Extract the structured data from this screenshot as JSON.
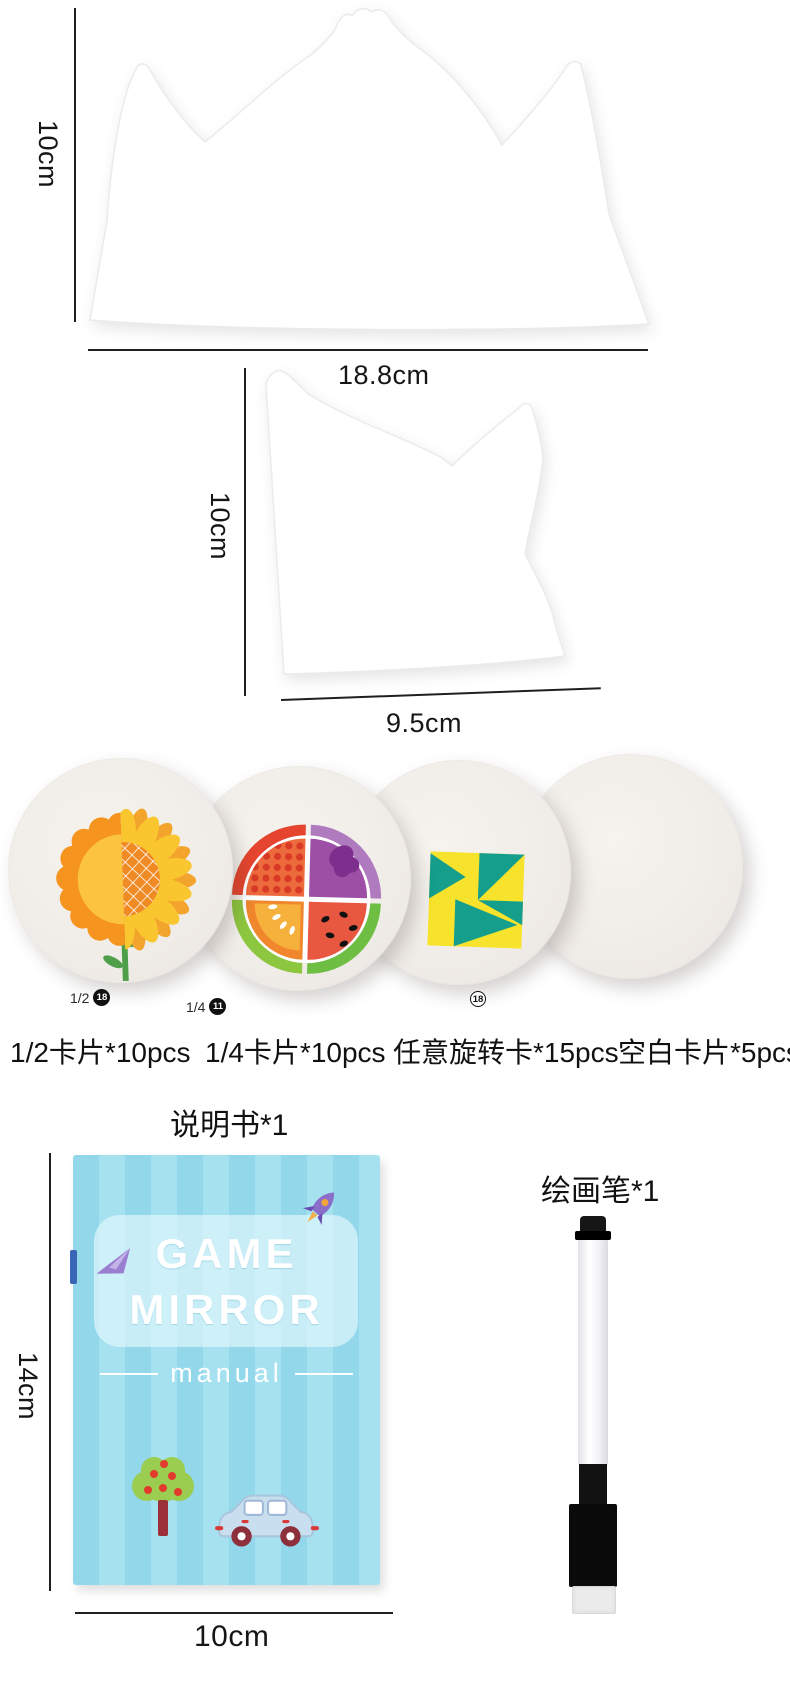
{
  "boards": {
    "large": {
      "height_label": "10cm",
      "width_label": "18.8cm"
    },
    "half": {
      "height_label": "10cm",
      "width_label": "9.5cm"
    }
  },
  "cards": {
    "items": [
      {
        "caption": "1/2卡片*10pcs",
        "badge_prefix": "1/2",
        "badge_number": "18"
      },
      {
        "caption": "1/4卡片*10pcs",
        "badge_prefix": "1/4",
        "badge_number": "11"
      },
      {
        "caption": "任意旋转卡*15pcs",
        "badge_prefix": "",
        "badge_number": "18"
      },
      {
        "caption": "空白卡片*5pcs",
        "badge_prefix": "",
        "badge_number": ""
      }
    ]
  },
  "manual": {
    "label": "说明书*1",
    "cover_title_line1": "GAME",
    "cover_title_line2": "MIRROR",
    "cover_subtitle": "manual",
    "height_label": "14cm",
    "width_label": "10cm"
  },
  "pen": {
    "label": "绘画笔*1"
  },
  "colors": {
    "dimension_line": "#1f1f1f",
    "card_surface": "#f1ede9",
    "sun_orange": "#F5941F",
    "sun_core_yellow": "#FBC340",
    "petal_yellow": "#F9C62F",
    "petal_orange": "#F2A42C",
    "flower_center_orange": "#EF8A24",
    "stem_green": "#4E9E4A",
    "rim_red": "#E5452E",
    "rim_purple": "#B07BBE",
    "rim_green_light": "#8DC63F",
    "rim_green": "#6EBE44",
    "quad_dots_bg": "#ED6A3C",
    "quad_dots": "#D93A26",
    "quad_purple": "#9C4FA5",
    "quad_purple_blob": "#7C2F8C",
    "quad_melon_bg": "#F0872C",
    "quad_melon": "#F6B03C",
    "quad_flesh": "#E8573F",
    "geo_teal": "#159E8C",
    "geo_yellow": "#F7E32C",
    "booklet_stripe_a": "#93d7eb",
    "booklet_stripe_b": "#a6e1f0",
    "booklet_panel": "#def5fb",
    "pen_black": "#111111",
    "pen_felt": "#ededed"
  }
}
